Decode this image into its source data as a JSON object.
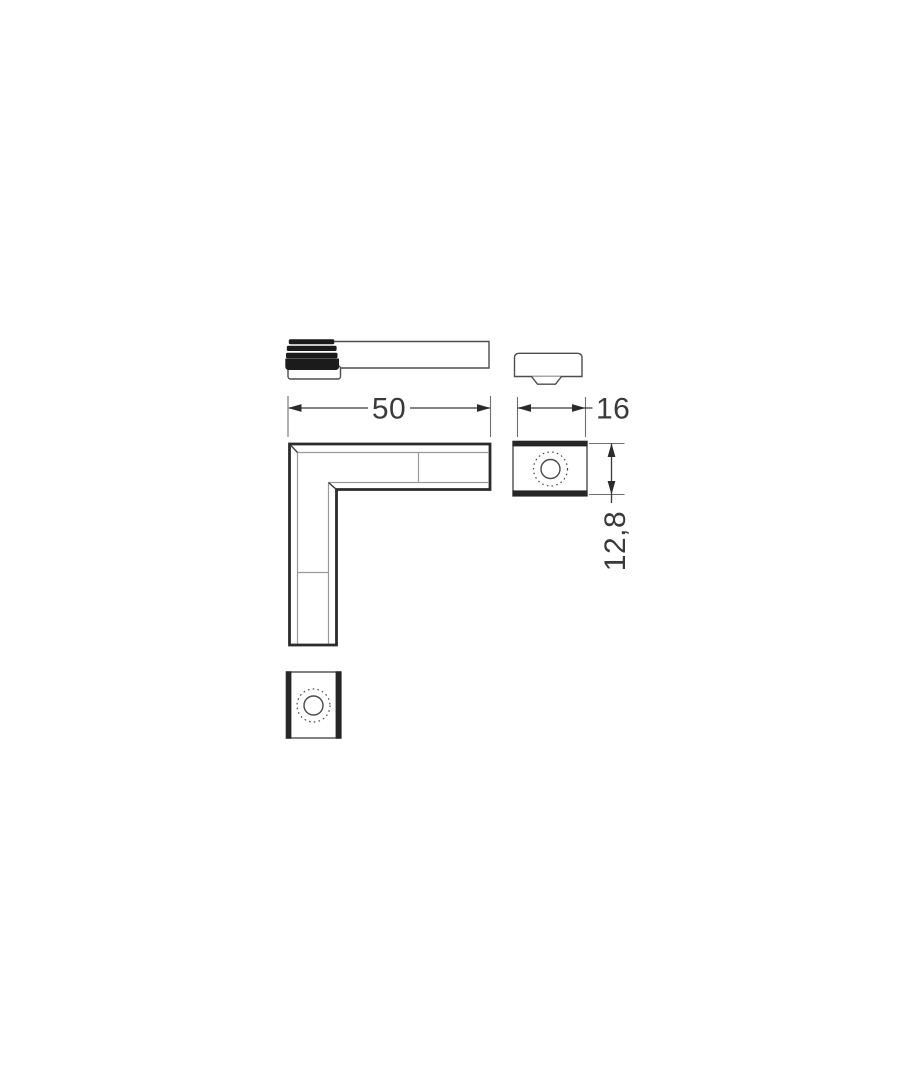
{
  "drawing": {
    "background": "#ffffff",
    "colors": {
      "outline_strong": "#2b2b2b",
      "outline_medium": "#4d4d4d",
      "thin_line": "#9a9a9a",
      "cap_fill": "#1b1b1b",
      "dimension_text": "#3a3a3a"
    },
    "dimensions": {
      "length_label": "50",
      "width_label": "16",
      "height_label": "12,8"
    }
  }
}
